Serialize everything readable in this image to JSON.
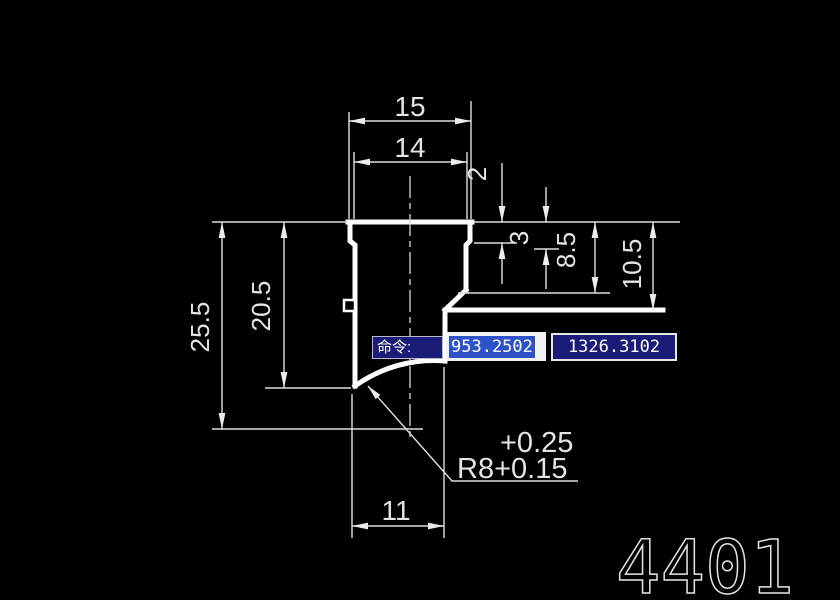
{
  "window": {
    "background": "#000000"
  },
  "drawing": {
    "number": "4401",
    "dims": {
      "width_top": "15",
      "width_upper": "14",
      "depth_step1": "2",
      "depth_step2": "3",
      "depth_shoulder": "8.5",
      "depth_flange": "10.5",
      "height_total": "25.5",
      "height_body": "20.5",
      "width_bottom": "11",
      "radius_tol_upper": "+0.25",
      "radius_label": "R8+0.15"
    }
  },
  "command_bar": {
    "prompt": "命令:",
    "coord_x": "953.2502",
    "coord_y": "1326.3102"
  },
  "colors": {
    "background": "#000000",
    "outline": "#ffffff",
    "dimension_line": "#dedede",
    "text": "#e4e4e4",
    "panel_bg": "#1b1b78",
    "panel_border": "#e8e8e8",
    "field_bg": "#f2f2f2",
    "selection_highlight": "#2e52c8",
    "selection_text": "#ffffff"
  }
}
